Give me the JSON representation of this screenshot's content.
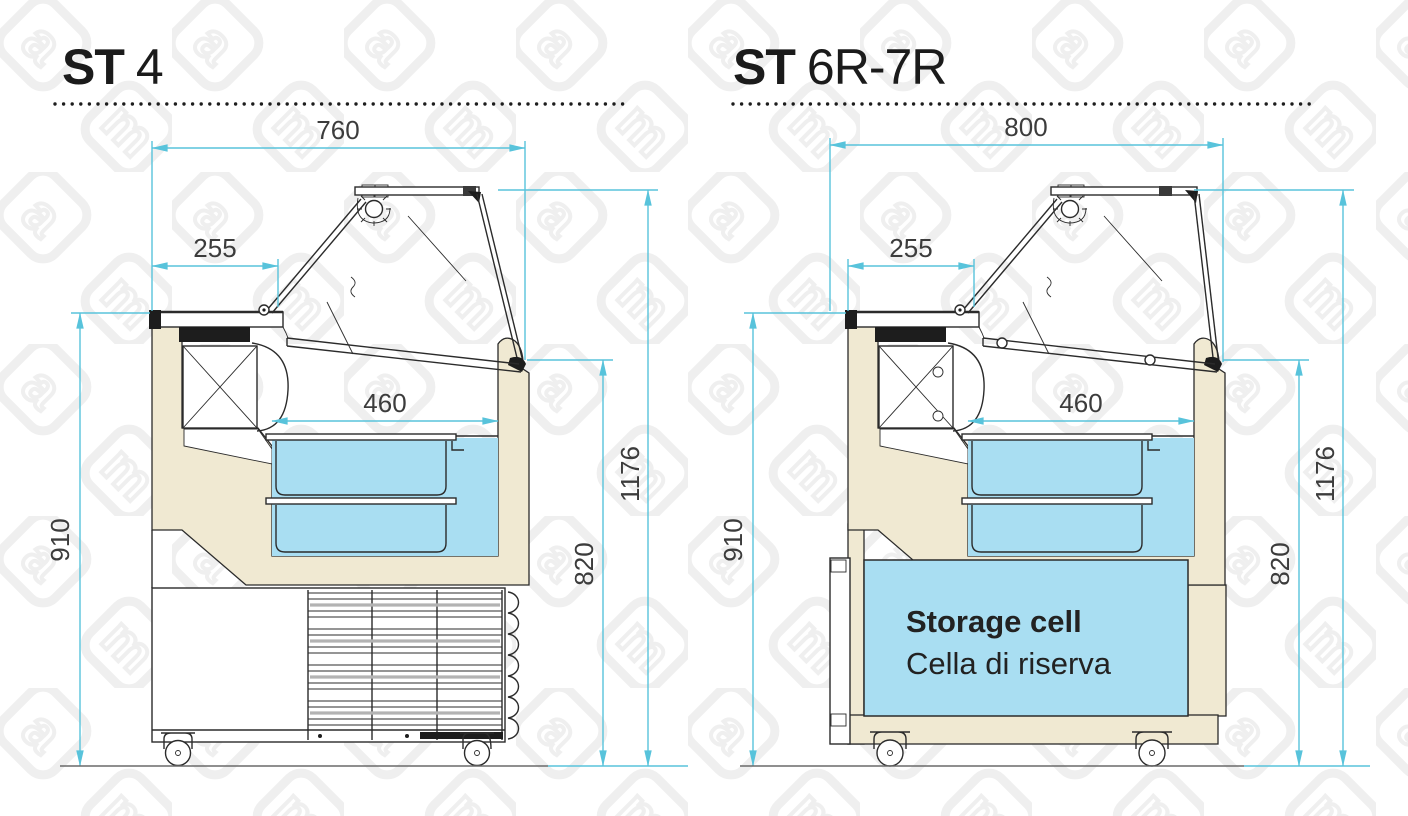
{
  "watermark": {
    "letters": [
      "a",
      "m"
    ]
  },
  "colors": {
    "dimension": "#58c3db",
    "cream": "#f0e9d2",
    "pan_blue": "#a9def2",
    "line": "#2b2b2b",
    "title": "#1b1b1b",
    "dim_text": "#3c3c3c"
  },
  "panels": {
    "left": {
      "title_prefix": "ST",
      "title_model": "4",
      "dims": {
        "top_width": "760",
        "rear_depth": "255",
        "opening": "460",
        "counter_height": "910",
        "overall_height": "1176",
        "front_height": "820"
      }
    },
    "right": {
      "title_prefix": "ST",
      "title_model": "6R-7R",
      "dims": {
        "top_width": "800",
        "rear_depth": "255",
        "opening": "460",
        "counter_height": "910",
        "overall_height": "1176",
        "front_height": "820"
      },
      "storage_cell": {
        "label_en": "Storage cell",
        "label_it": "Cella di riserva"
      }
    }
  }
}
